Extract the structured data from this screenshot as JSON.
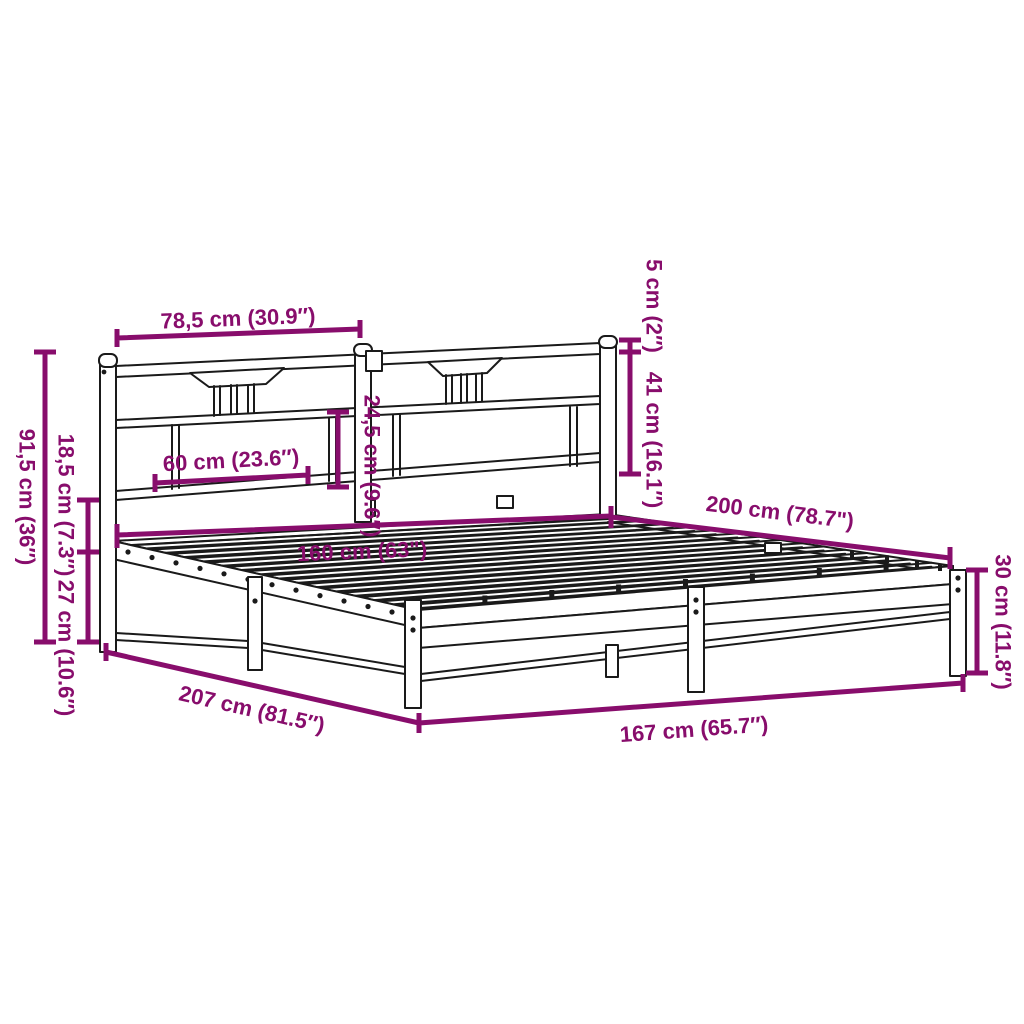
{
  "diagram": {
    "background": "#ffffff",
    "accent_color": "#880d6c",
    "line_color": "#1a1a1a",
    "labels": {
      "hb_section_width": "78,5 cm (30.9″)",
      "cap_height": "5 cm (2″)",
      "headboard_height": "41 cm (16.1″)",
      "panel_height": "24,5 cm (9.6″)",
      "panel_width": "60 cm (23.6″)",
      "total_height": "91,5 cm (36″)",
      "rail_height": "18,5 cm (7.3″)",
      "clearance": "27 cm (10.6″)",
      "width_inner": "160 cm (63\")",
      "length_inner": "200 cm (78.7\")",
      "foot_height": "30 cm (11.8″)",
      "length_outer": "207 cm (81.5″)",
      "width_outer": "167 cm (65.7″)"
    }
  }
}
